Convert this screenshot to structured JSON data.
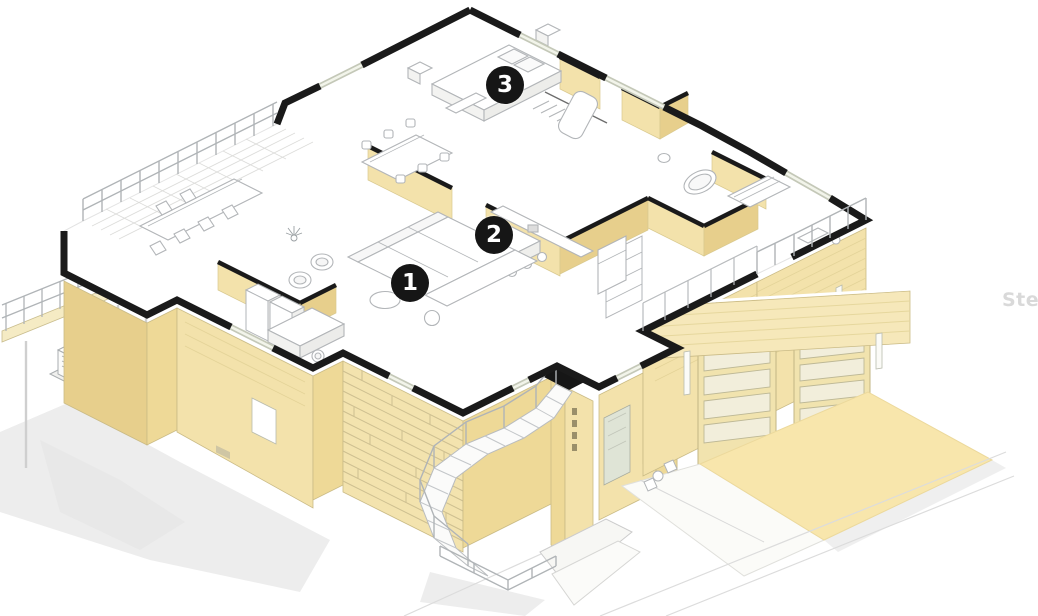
{
  "scene": {
    "type": "isometric-cutaway-floor-plan",
    "floor_shown": "main level with exterior below"
  },
  "markers": [
    {
      "number": "1"
    },
    {
      "number": "2"
    },
    {
      "number": "3"
    }
  ],
  "watermark": {
    "text": "Stel"
  },
  "colors": {
    "marker_bg": "#161616",
    "marker_text": "#ffffff",
    "watermark": "#d9d9d9",
    "wall_light": "#f3e2ab",
    "wall_mid": "#eed997",
    "wall_dark": "#e7cf8c",
    "cut_wall": "#1a1a1a",
    "floor": "#ffffff",
    "furniture_line": "#b2b5b8",
    "glass": "#e9ecde",
    "driveway": "#f8e6ac",
    "shadow": "#ebebeb"
  }
}
